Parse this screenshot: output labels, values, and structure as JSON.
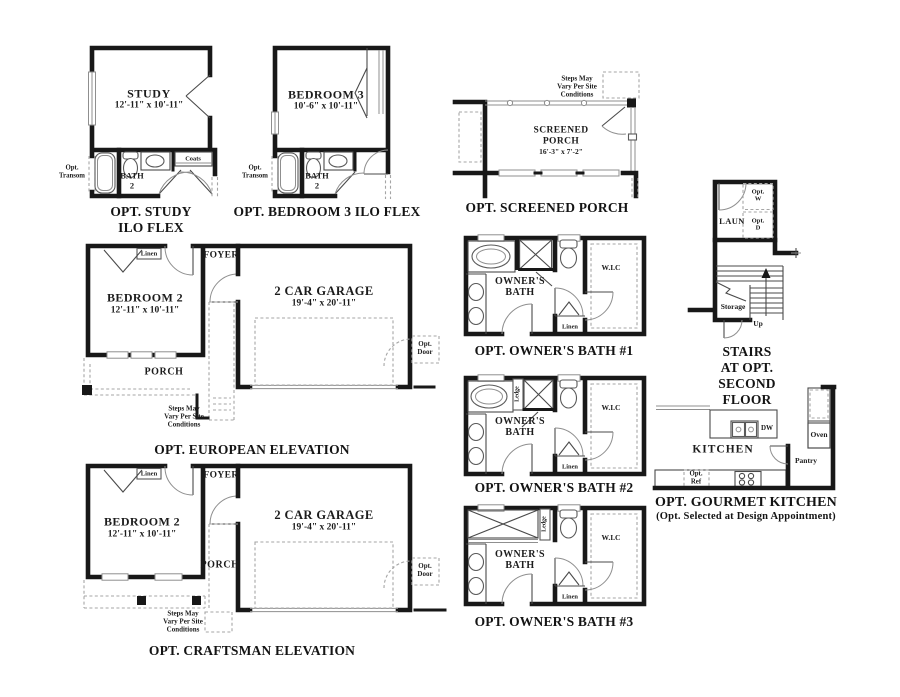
{
  "sheet": {
    "background": "#ffffff",
    "ink": "#1a1a1a"
  },
  "panels": {
    "study": {
      "caption": "OPT. STUDY ILO FLEX",
      "room": "STUDY",
      "dims": "12'-11\" x 10'-11\"",
      "transom": "Opt.\nTransom",
      "bath": "BATH\n2",
      "coats": "Coats"
    },
    "bedroom3": {
      "caption": "OPT. BEDROOM 3 ILO FLEX",
      "room": "BEDROOM 3",
      "dims": "10'-6\" x 10'-11\"",
      "transom": "Opt.\nTransom",
      "bath": "BATH\n2"
    },
    "screened_porch": {
      "caption": "OPT. SCREENED PORCH",
      "room": "SCREENED\nPORCH",
      "dims": "16'-3\" x 7'-2\"",
      "steps_note": "Steps May\nVary Per Site\nConditions"
    },
    "stairs": {
      "caption": "STAIRS AT OPT.\nSECOND FLOOR",
      "laundry": "LAUN",
      "opt_washer": "Opt.\nW",
      "opt_dryer": "Opt.\nD",
      "storage": "Storage",
      "up": "Up"
    },
    "owners_bath_1": {
      "caption": "OPT. OWNER'S BATH #1",
      "room": "OWNER'S\nBATH",
      "closet": "W.I.C",
      "linen": "Linen"
    },
    "owners_bath_2": {
      "caption": "OPT. OWNER'S BATH #2",
      "room": "OWNER'S\nBATH",
      "closet": "W.I.C",
      "linen": "Linen",
      "ledge": "Ledge"
    },
    "owners_bath_3": {
      "caption": "OPT. OWNER'S BATH #3",
      "room": "OWNER'S\nBATH",
      "closet": "W.I.C",
      "linen": "Linen",
      "ledge": "Ledge"
    },
    "european": {
      "caption": "OPT. EUROPEAN ELEVATION",
      "bedroom": "BEDROOM 2",
      "bedroom_dims": "12'-11\" x 10'-11\"",
      "linen": "Linen",
      "foyer": "FOYER",
      "porch": "PORCH",
      "garage": "2 CAR GARAGE",
      "garage_dims": "19'-4\" x 20'-11\"",
      "opt_door": "Opt.\nDoor",
      "steps_note": "Steps May\nVary Per Site\nConditions"
    },
    "craftsman": {
      "caption": "OPT. CRAFTSMAN ELEVATION",
      "bedroom": "BEDROOM 2",
      "bedroom_dims": "12'-11\" x 10'-11\"",
      "linen": "Linen",
      "foyer": "FOYER",
      "porch": "PORCH",
      "garage": "2 CAR GARAGE",
      "garage_dims": "19'-4\" x 20'-11\"",
      "opt_door": "Opt.\nDoor",
      "steps_note": "Steps May\nVary Per Site\nConditions"
    },
    "kitchen": {
      "caption": "OPT. GOURMET KITCHEN",
      "subcaption": "(Opt. Selected at Design Appointment)",
      "room": "KITCHEN",
      "dishwasher": "DW",
      "oven": "Oven",
      "pantry": "Pantry",
      "opt_ref": "Opt.\nRef"
    }
  }
}
